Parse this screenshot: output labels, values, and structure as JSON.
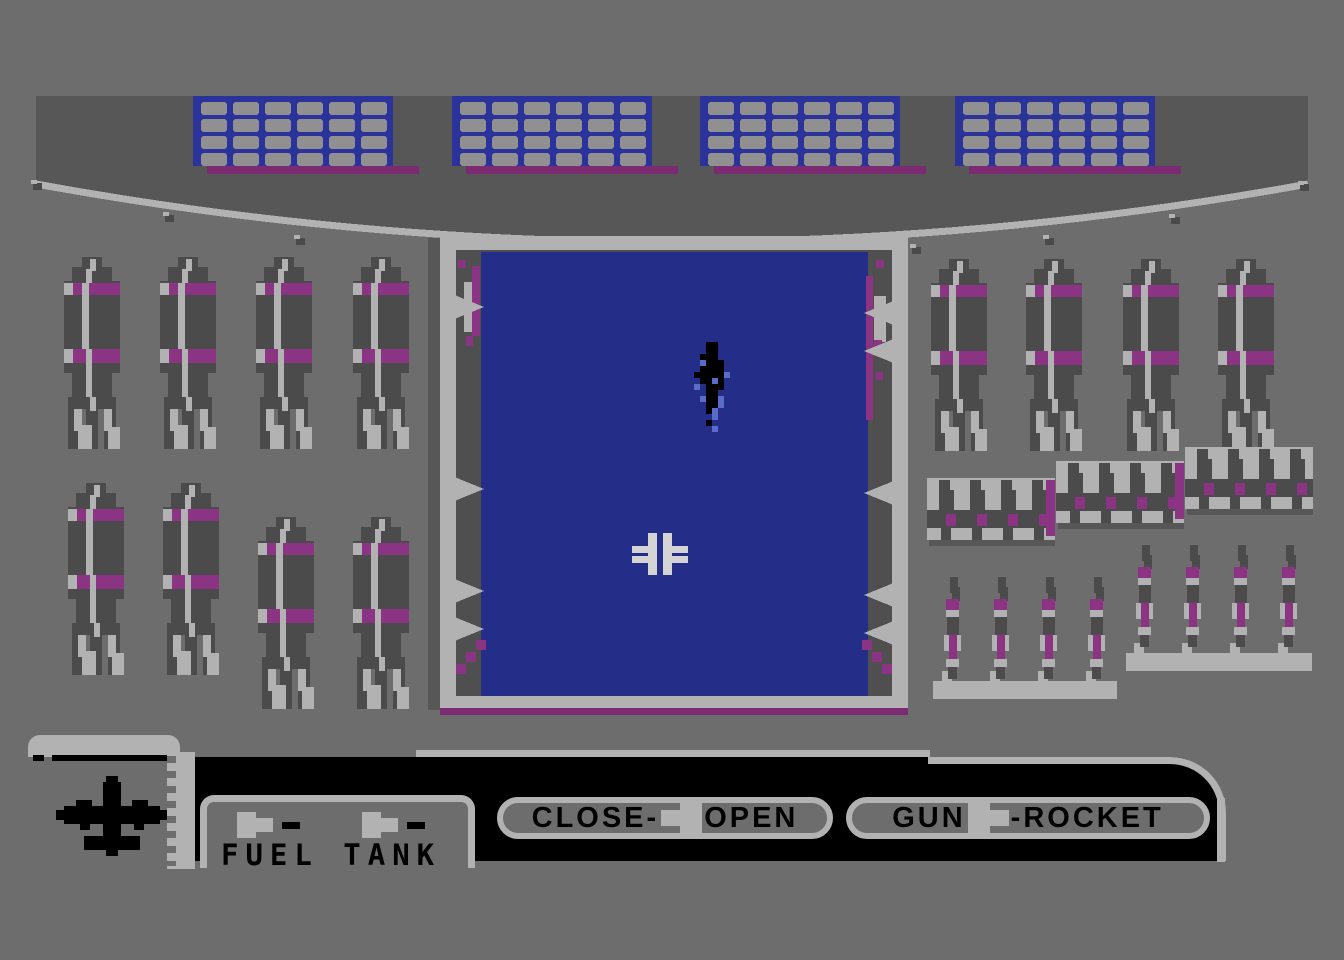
{
  "hud": {
    "fuel_panel": {
      "label": "FUEL TANK",
      "selector_count": 2
    },
    "bay_doors_button": {
      "left": "CLOSE-",
      "right": "OPEN"
    },
    "weapon_button": {
      "left": "GUN",
      "right": "-ROCKET"
    }
  },
  "colors": {
    "background": "#6d6d6d",
    "ceiling_band": "#575757",
    "munition_dark": "#4b4b4b",
    "bay_inner_dark": "#4f4f4f",
    "light_gray": "#b2b2b2",
    "rivet_gray": "#909090",
    "purple": "#8c3484",
    "purple_dark": "#7c2a72",
    "panel_blue": "#2b339b",
    "bay_blue": "#242e88",
    "splash_blue": "#5a6bc8",
    "crosshair": "#d4d4d4",
    "black": "#000000"
  },
  "scene": {
    "ceiling_panels": {
      "count": 4,
      "rivet_rows": 4,
      "rivets_per_row": 6
    },
    "bomb_racks": {
      "left_top_bombs": 4,
      "left_bottom_bombs": 4,
      "right_top_bombs": 4,
      "right_shelf_racks": {
        "count": 3,
        "bombs_per_rack": 4
      },
      "rocket_groups": [
        4,
        4
      ]
    },
    "bay": {
      "target": "ship-top-view",
      "crosshair": "balkenkreuz-sight",
      "doors_state_shown": "open"
    }
  }
}
